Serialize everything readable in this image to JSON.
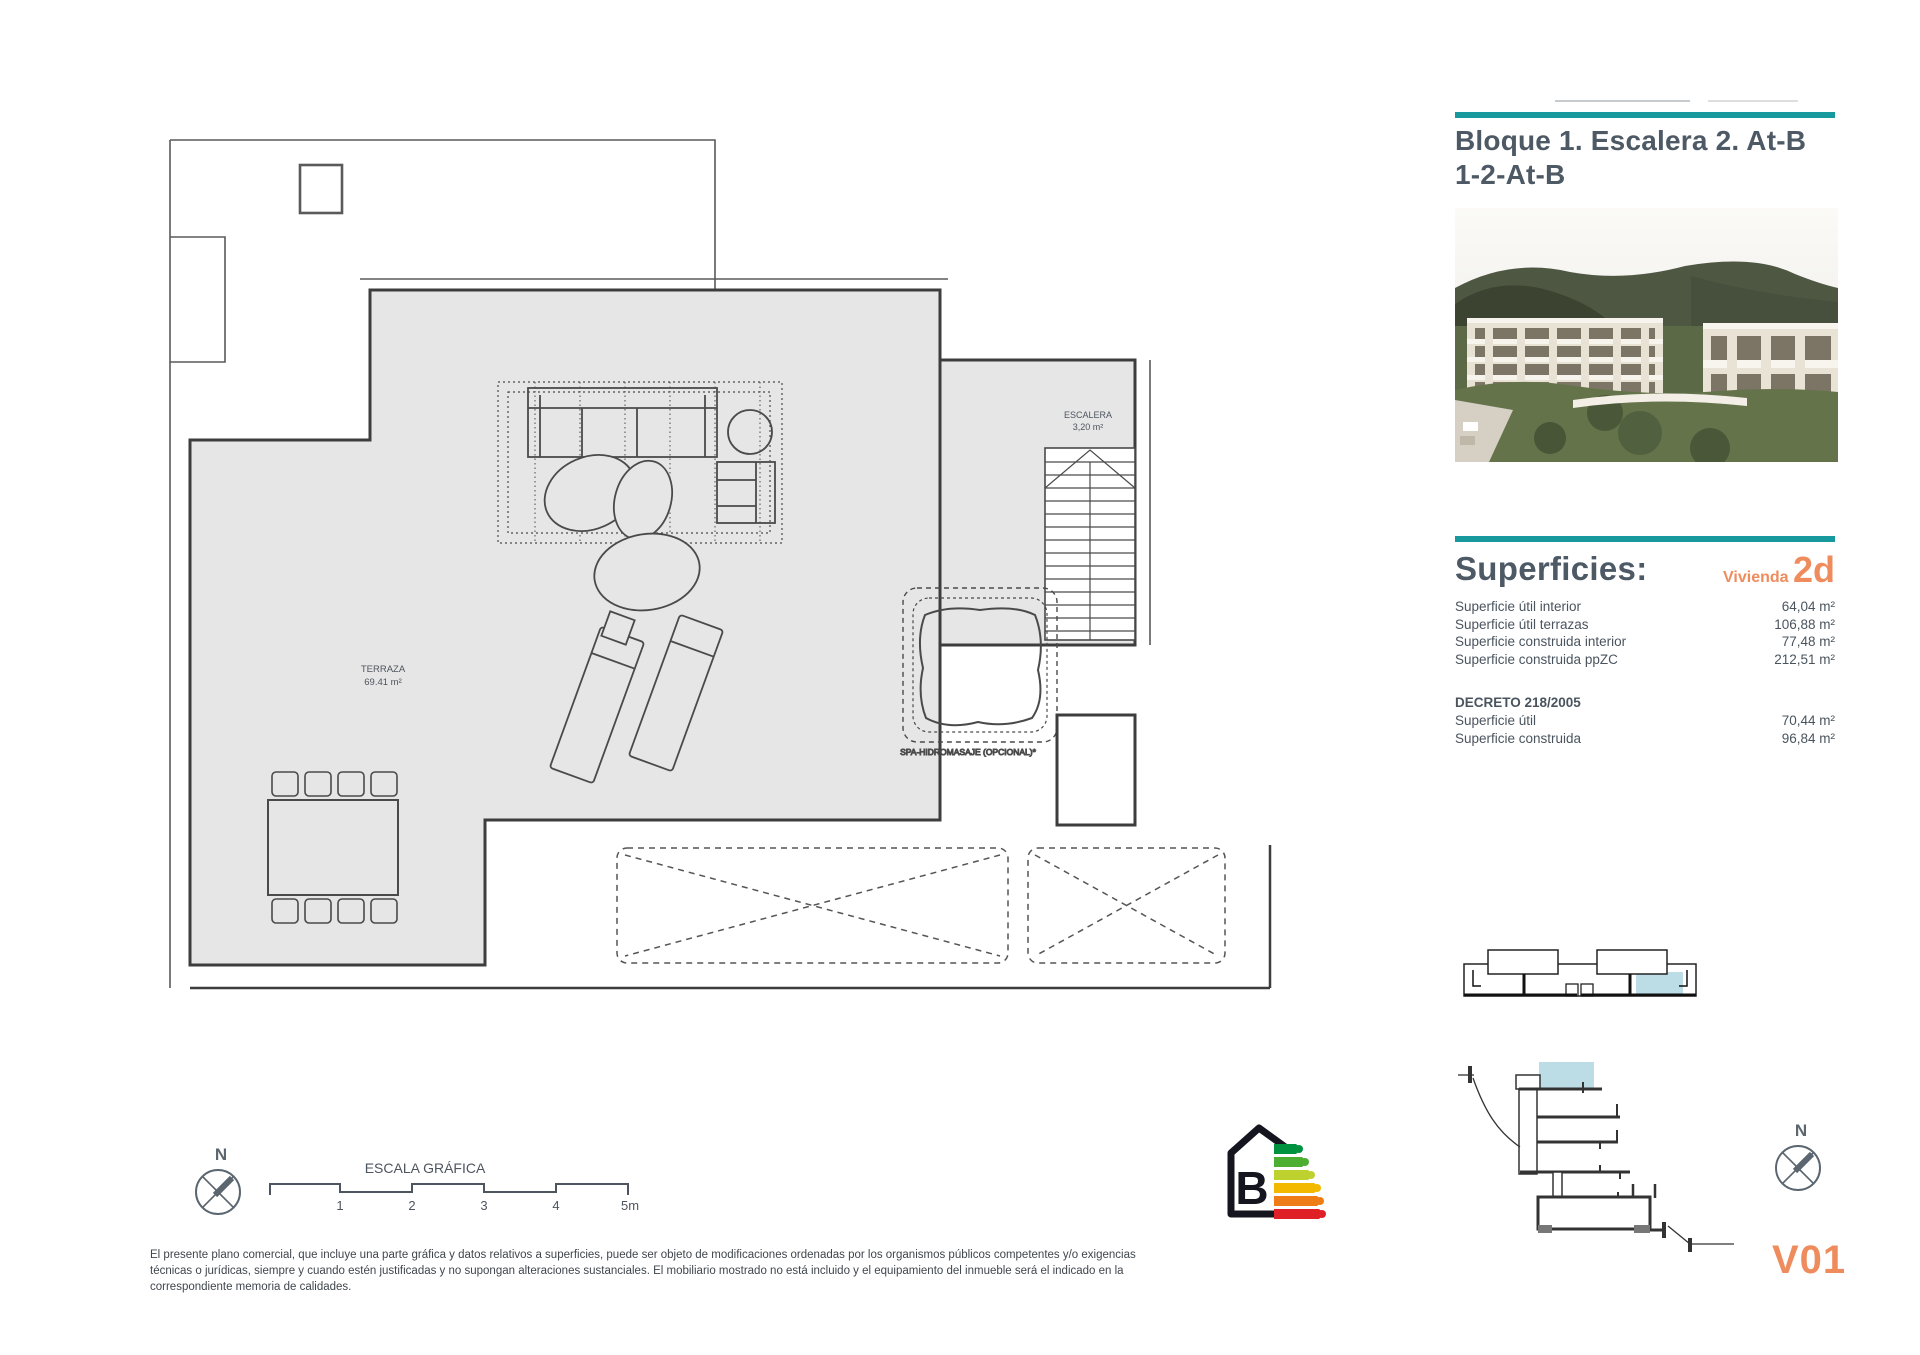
{
  "header": {
    "title_line1": "Bloque 1. Escalera 2. At-B",
    "title_line2": "1-2-At-B"
  },
  "plan": {
    "terraza_label": "TERRAZA",
    "terraza_area": "69.41 m²",
    "escalera_label": "ESCALERA",
    "escalera_area": "3,20 m²",
    "spa_label": "SPA-HIDROMASAJE (OPCIONAL)*"
  },
  "superficies": {
    "heading": "Superficies:",
    "vivienda_label": "Vivienda",
    "vivienda_value": "2d",
    "rows": [
      {
        "label": "Superficie útil interior",
        "value": "64,04 m²"
      },
      {
        "label": "Superficie útil terrazas",
        "value": "106,88 m²"
      },
      {
        "label": "Superficie construida interior",
        "value": "77,48 m²"
      },
      {
        "label": "Superficie construida ppZC",
        "value": "212,51 m²"
      }
    ],
    "decreto": {
      "heading": "DECRETO 218/2005",
      "rows": [
        {
          "label": "Superficie útil",
          "value": "70,44 m²"
        },
        {
          "label": "Superficie construida",
          "value": "96,84 m²"
        }
      ]
    }
  },
  "scale_bar": {
    "label": "ESCALA GRÁFICA",
    "ticks": [
      "1",
      "2",
      "3",
      "4",
      "5m"
    ]
  },
  "compass": {
    "label": "N"
  },
  "energy": {
    "rating": "B"
  },
  "version_code": "V01",
  "disclaimer": "El presente plano comercial, que incluye una parte gráfica y datos relativos a superficies, puede ser objeto de modificaciones ordenadas por los organismos públicos competentes y/o exigencias técnicas o jurídicas, siempre y cuando estén justificadas y no supongan alteraciones sustanciales. El mobiliario mostrado no está incluido y el equipamiento del inmueble será el indicado en la correspondiente memoria de calidades.",
  "colors": {
    "accent_teal": "#18999e",
    "accent_orange": "#ee8c5e",
    "highlight_blue": "#bcdde6",
    "plan_fill": "#e6e6e6",
    "energy_arrows": [
      "#00923f",
      "#4caf32",
      "#bed22f",
      "#f3b800",
      "#ef7d17",
      "#e02027"
    ]
  }
}
